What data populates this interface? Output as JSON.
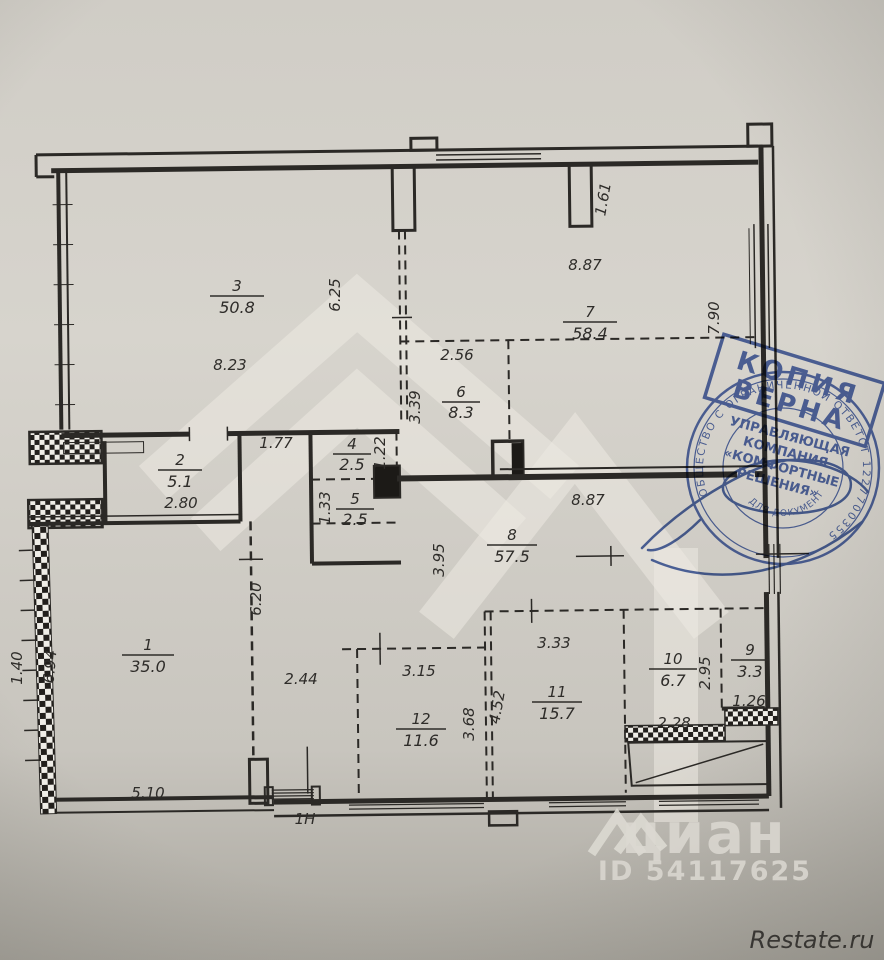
{
  "rooms": [
    {
      "number": "1",
      "area": "35.0"
    },
    {
      "number": "2",
      "area": "5.1"
    },
    {
      "number": "3",
      "area": "50.8"
    },
    {
      "number": "4",
      "area": "2.5"
    },
    {
      "number": "5",
      "area": "2.5"
    },
    {
      "number": "6",
      "area": "8.3"
    },
    {
      "number": "7",
      "area": "58.4"
    },
    {
      "number": "8",
      "area": "57.5"
    },
    {
      "number": "9",
      "area": "3.3"
    },
    {
      "number": "10",
      "area": "6.7"
    },
    {
      "number": "11",
      "area": "15.7"
    },
    {
      "number": "12",
      "area": "11.6"
    }
  ],
  "dims": {
    "room3_w": "8.23",
    "room3_h": "6.25",
    "top_niche": "1.61",
    "room7_w": "8.87",
    "room7_h": "7.90",
    "room6_w": "2.56",
    "room6_h": "3.39",
    "closet_w": "1.77",
    "closet_h": "1.22",
    "closet2_h": "1.33",
    "room2_w": "2.80",
    "hall_w": "8.87",
    "hall_h": "3.95",
    "room1_h": "6.94",
    "room1_w": "5.10",
    "hall_left_h": "6.20",
    "hall_gap": "2.44",
    "room12_w": "3.15",
    "room12_h": "3.68",
    "room11_h": "4.52",
    "room11_w": "3.33",
    "room10_h": "2.95",
    "room10_w": "2.28",
    "room9_w": "1.26",
    "left_edge": "1.40"
  },
  "unit_label": "1Н",
  "stamp_rect": {
    "line1": "КОПИЯ",
    "line2": "ВЕРНА"
  },
  "stamp_round": {
    "ring_top": "ОБЩЕСТВО С ОГРАНИЧЕННОЙ ОТВЕТСТВЕННОСТЬЮ",
    "ring_right": "1227700355",
    "org_line1": "УПРАВЛЯЮЩАЯ",
    "org_line2": "КОМПАНИЯ",
    "org_line3": "«КОМФОРТНЫЕ",
    "org_line4": "РЕШЕНИЯ»",
    "bottom": "ДЛЯ ДОКУМЕНТОВ"
  },
  "watermark": {
    "brand": "циан",
    "listing_id": "ID 54117625",
    "credit": "Restate.ru"
  },
  "colors": {
    "stamp_blue": "#3a57a8",
    "paper": "#d5d2cb",
    "ink": "#2e2c29"
  }
}
